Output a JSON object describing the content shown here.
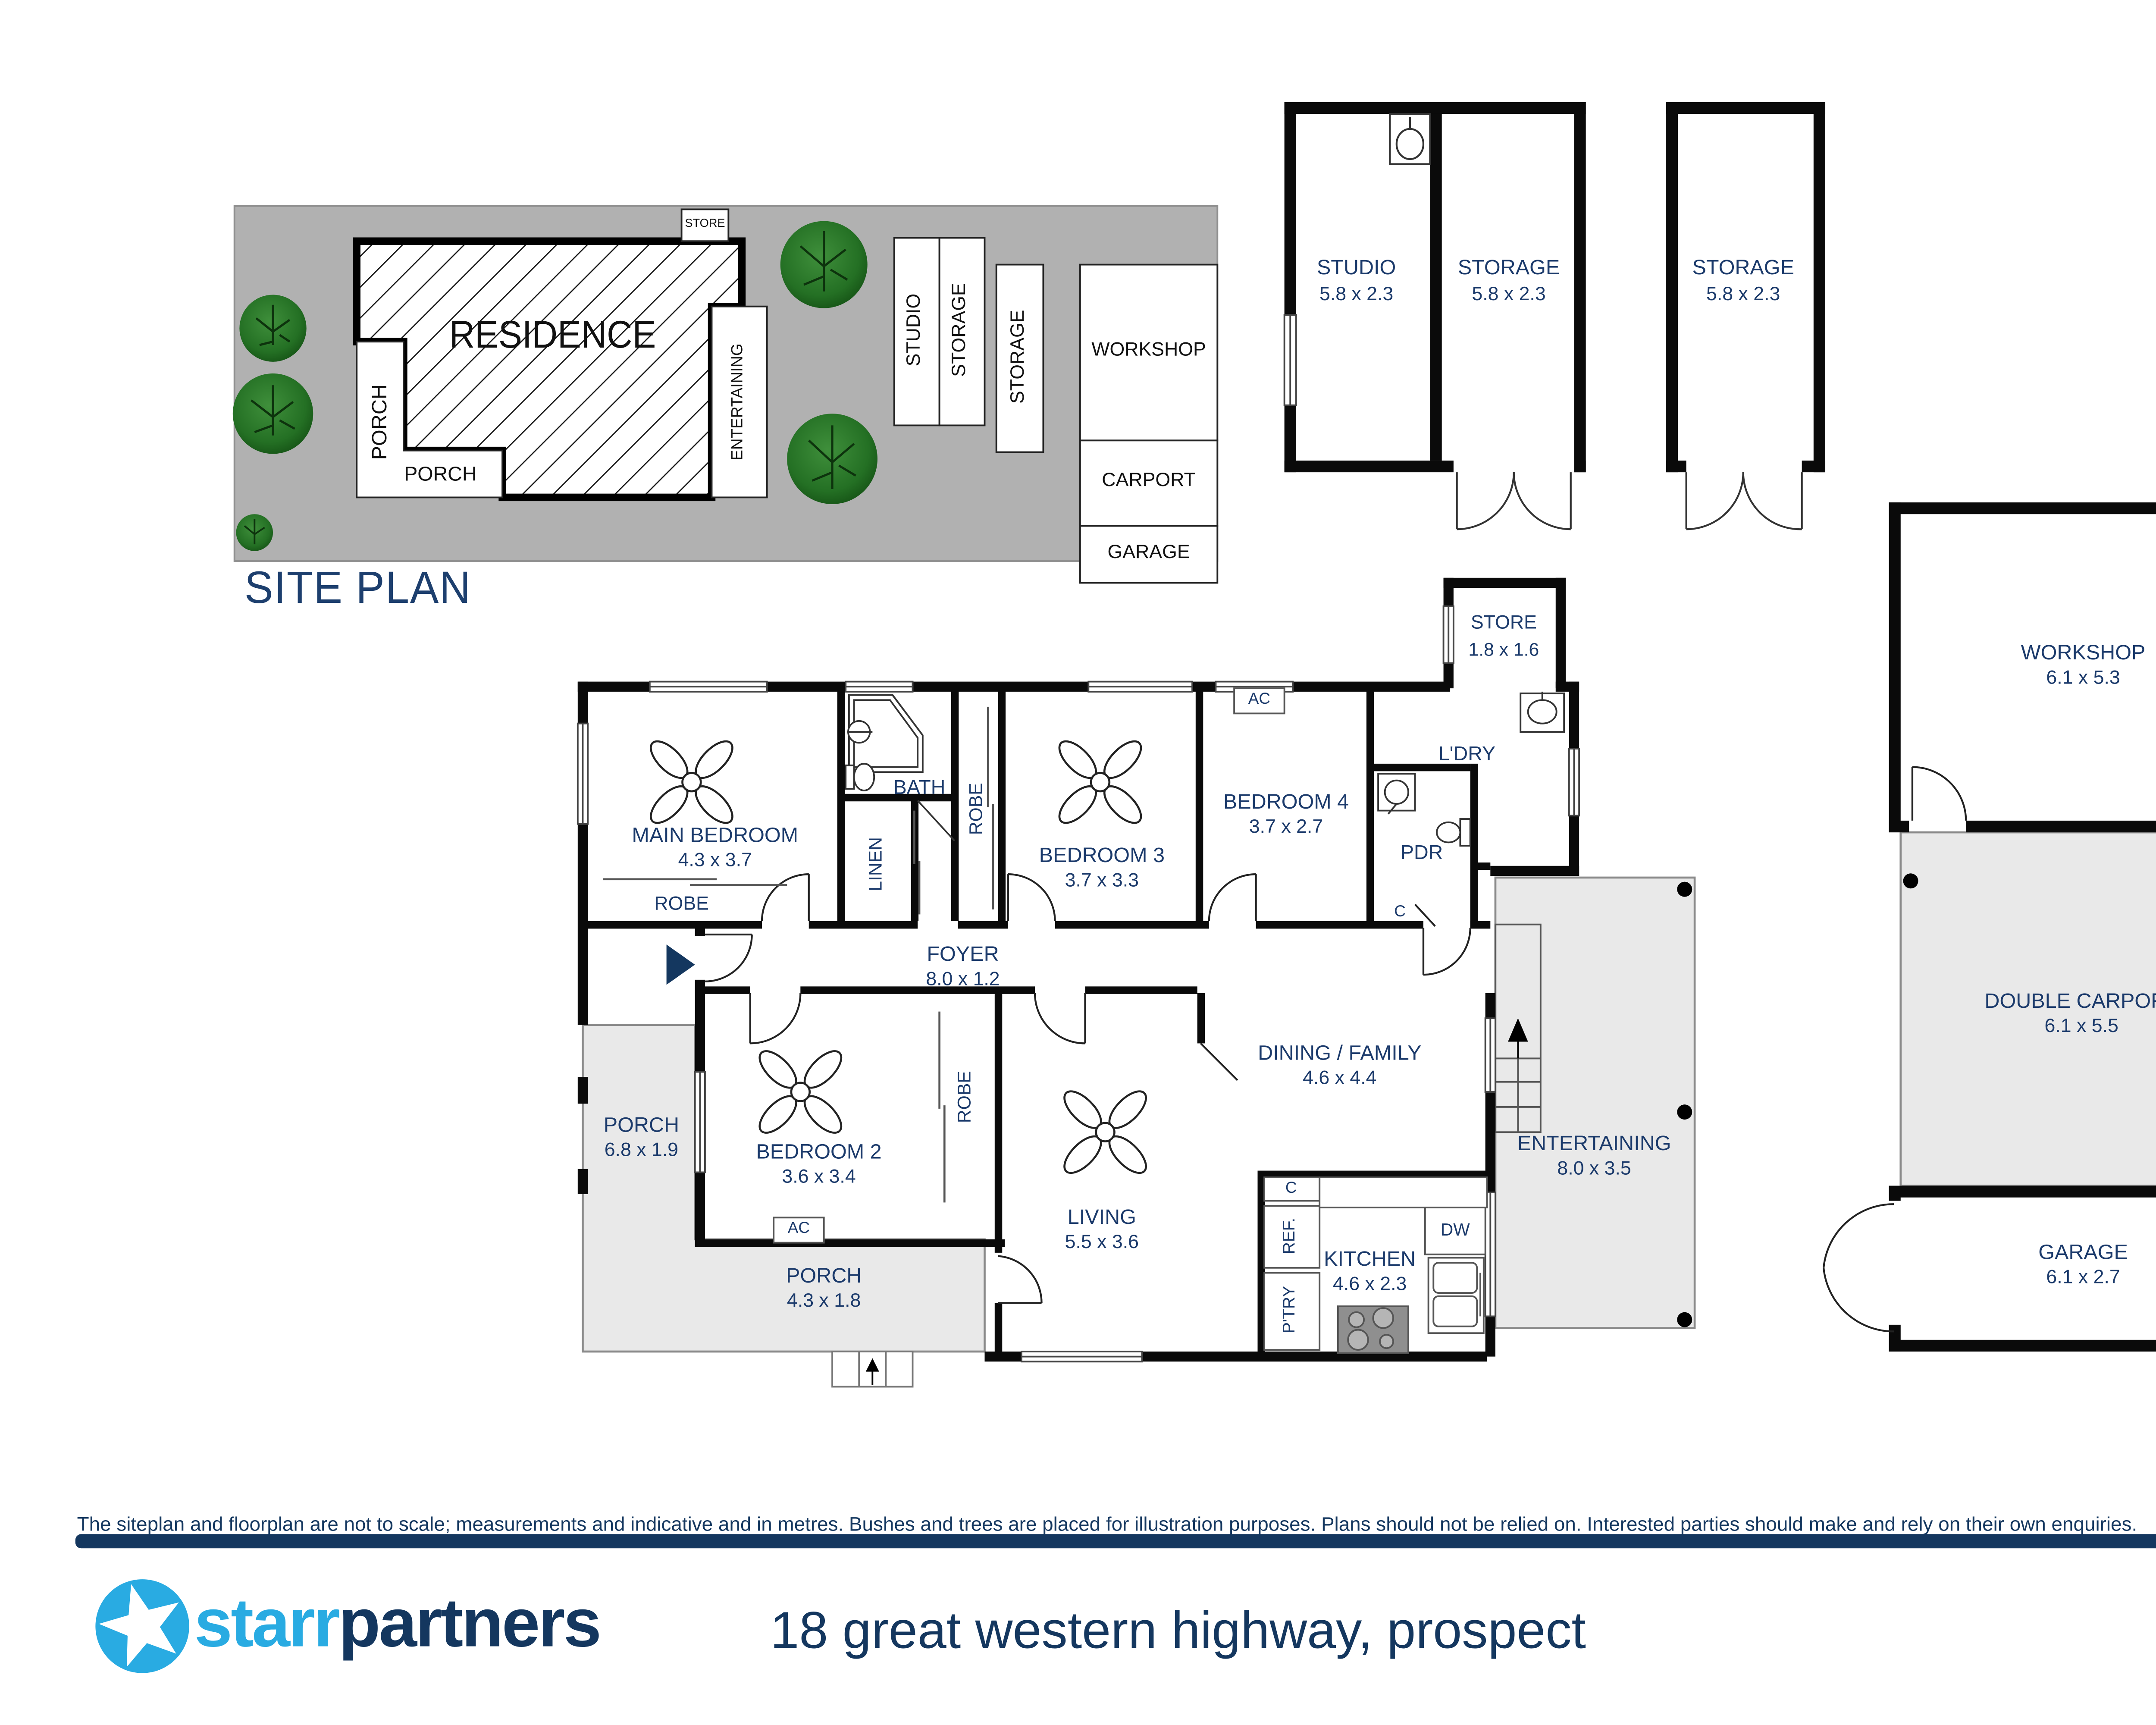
{
  "site_plan": {
    "title": "SITE PLAN",
    "residence": "RESIDENCE",
    "porch_left": "PORCH",
    "porch_bottom": "PORCH",
    "entertaining": "ENTERTAINING",
    "store": "STORE",
    "studio": "STUDIO",
    "storage_a": "STORAGE",
    "storage_b": "STORAGE",
    "workshop": "WORKSHOP",
    "carport": "CARPORT",
    "garage": "GARAGE"
  },
  "outbuildings": {
    "studio": {
      "name": "STUDIO",
      "dims": "5.8 x 2.3"
    },
    "storage_a": {
      "name": "STORAGE",
      "dims": "5.8 x 2.3"
    },
    "storage_b": {
      "name": "STORAGE",
      "dims": "5.8 x 2.3"
    }
  },
  "compass": {
    "label": "N"
  },
  "floorplan": {
    "main_bedroom": {
      "name": "MAIN BEDROOM",
      "dims": "4.3 x 3.7"
    },
    "robe_main": "ROBE",
    "bath": "BATH",
    "linen": "LINEN",
    "robe_hall": "ROBE",
    "bedroom3": {
      "name": "BEDROOM 3",
      "dims": "3.7 x 3.3"
    },
    "bedroom4": {
      "name": "BEDROOM 4",
      "dims": "3.7 x 2.7"
    },
    "ac_bed4": "AC",
    "ldry": "L'DRY",
    "store": {
      "name": "STORE",
      "dims": "1.8 x 1.6"
    },
    "pdr": "PDR",
    "cupboard_hall": "C",
    "foyer": {
      "name": "FOYER",
      "dims": "8.0 x 1.2"
    },
    "porch_side": {
      "name": "PORCH",
      "dims": "6.8 x 1.9"
    },
    "bedroom2": {
      "name": "BEDROOM 2",
      "dims": "3.6 x 3.4"
    },
    "ac_bed2": "AC",
    "robe_bed2": "ROBE",
    "porch_front": {
      "name": "PORCH",
      "dims": "4.3 x 1.8"
    },
    "living": {
      "name": "LIVING",
      "dims": "5.5 x 3.6"
    },
    "dining": {
      "name": "DINING / FAMILY",
      "dims": "4.6 x 4.4"
    },
    "cupboard_kitchen": "C",
    "fridge": "REF.",
    "pantry": "P'TRY",
    "kitchen": {
      "name": "KITCHEN",
      "dims": "4.6 x 2.3"
    },
    "dishwasher": "DW",
    "entertaining": {
      "name": "ENTERTAINING",
      "dims": "8.0 x 3.5"
    }
  },
  "annexe": {
    "workshop": {
      "name": "WORKSHOP",
      "dims": "6.1 x 5.3"
    },
    "carport": {
      "name": "DOUBLE CARPORT",
      "dims": "6.1 x 5.5"
    },
    "garage": {
      "name": "GARAGE",
      "dims": "6.1 x 2.7"
    }
  },
  "footer": {
    "disclaimer": "The siteplan and floorplan are not to scale; measurements and indicative and in metres. Bushes and trees are placed for illustration purposes. Plans should not be relied on. Interested parties should make and rely on their own enquiries.",
    "brand_first": "starr",
    "brand_second": "partners",
    "address": "18 great western highway, prospect"
  },
  "colors": {
    "wall_black": "#0a0a0a",
    "label_navy": "#1b3a6b",
    "footer_navy": "#14375f",
    "brand_blue": "#29abe2",
    "site_gray": "#b1b1b1",
    "floor_gray": "#e9e9e9",
    "tree_green": "#2e7d32",
    "compass_light": "#b9c3d9"
  }
}
